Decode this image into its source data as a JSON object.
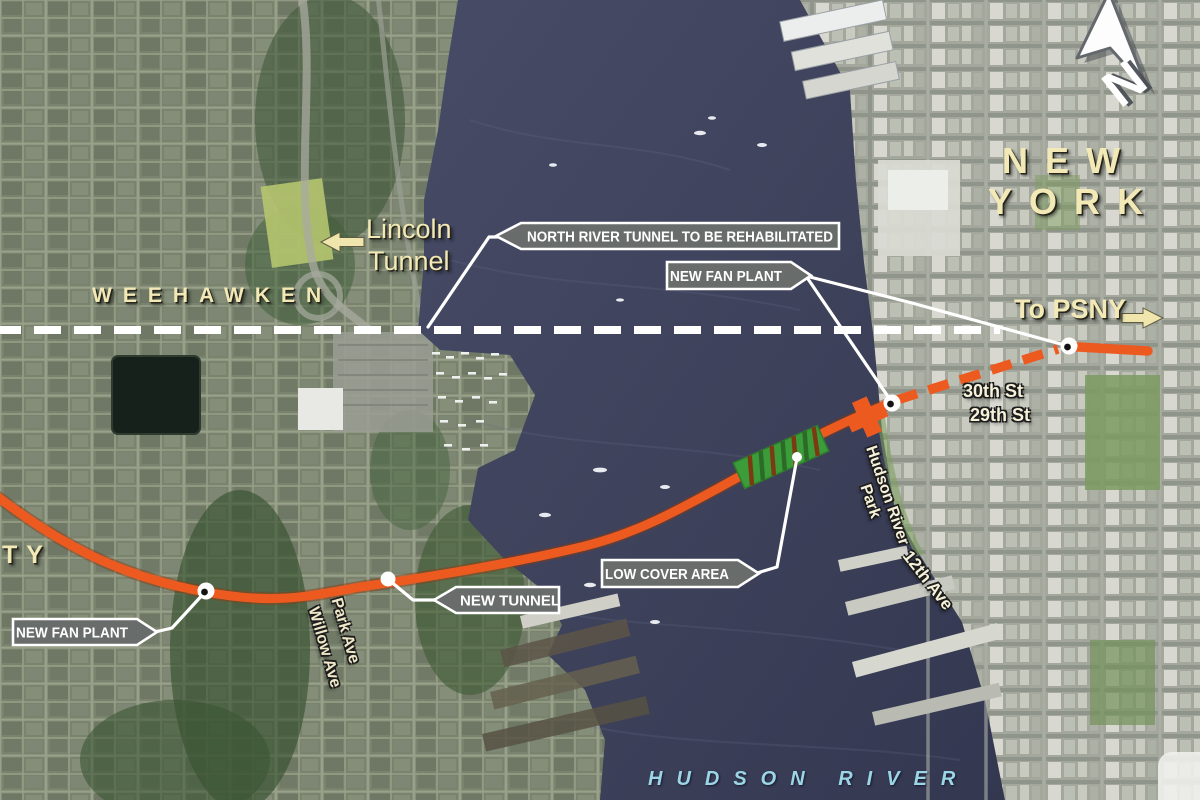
{
  "callouts": {
    "north_river_tunnel": "NORTH RIVER TUNNEL TO BE REHABILITATED",
    "new_fan_plant_ny": "NEW FAN PLANT",
    "new_fan_plant_nj": "NEW FAN PLANT",
    "new_tunnel": "NEW TUNNEL",
    "low_cover_area": "LOW COVER AREA"
  },
  "place_labels": {
    "new_york_line1": "NEW",
    "new_york_line2": "YORK",
    "weehawken": "WEEHAWKEN",
    "lincoln_tunnel_line1": "Lincoln",
    "lincoln_tunnel_line2": "Tunnel",
    "to_psny": "To PSNY",
    "city_partial": "TY",
    "street_30th": "30th St",
    "street_29th": "29th St",
    "hudson_river_park_line1": "Hudson River",
    "hudson_river_park_line2": "Park",
    "ave_12th": "12th Ave",
    "park_ave": "Park Ave",
    "willow_ave": "Willow Ave",
    "hudson_river": "HUDSON RIVER",
    "compass_north": "N"
  },
  "map_features": {
    "new_tunnel_line_color": "#ed5a20",
    "new_tunnel_dashed_segment": "30th St approach",
    "existing_tunnel_line_color": "#ffffff",
    "existing_tunnel_line_style": "dashed",
    "low_cover_marker_color": "#3d9c3a",
    "callout_box_color": "#686d6b",
    "place_label_color": "#f2e9b6",
    "hudson_river_text_color": "#9bd5e6",
    "water_color": "#3d415a"
  }
}
